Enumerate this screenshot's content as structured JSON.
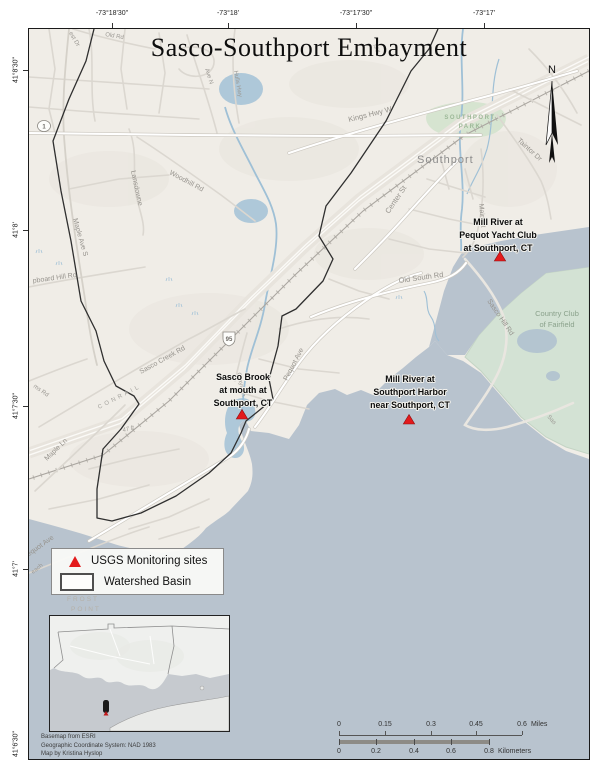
{
  "title": "Sasco-Southport Embayment",
  "north_label": "N",
  "axis": {
    "top": [
      "-73°18'30\"",
      "-73°18'",
      "-73°17'30\"",
      "-73°17'"
    ],
    "left": [
      "41°8'30\"",
      "41°8'",
      "41°7'30\"",
      "41°7'",
      "41°6'30\""
    ]
  },
  "sites": [
    {
      "lines": [
        "Mill River at",
        "Pequot Yacht Club",
        "at Southport, CT"
      ]
    },
    {
      "lines": [
        "Sasco Brook",
        "at mouth at",
        "Southport, CT"
      ]
    },
    {
      "lines": [
        "Mill River at",
        "Southport Harbor",
        "near Southport, CT"
      ]
    }
  ],
  "legend": {
    "monitoring_label": "USGS Monitoring sites",
    "watershed_label": "Watershed Basin"
  },
  "shields": {
    "interstate": "95",
    "us1": "1"
  },
  "map_labels": {
    "old_rd": "Old Rd",
    "est_dr": "est Dr",
    "ave_n": "Ave N",
    "hulls_hwy": "Hulls Hwy",
    "mill": "Mill",
    "kings_hwy_w": "Kings Hwy W",
    "woodhill_rd": "Woodhill Rd",
    "lansdowne": "Lansdowne",
    "maple_ave_s": "Maple Ave S",
    "taintor_dr": "Taintor Dr",
    "southport": "Southport",
    "southport_park_1": "SOUTHPORT",
    "southport_park_2": "PARK",
    "center_st": "Center St",
    "main_st": "Main St",
    "old_south_rd": "Old South Rd",
    "sasco_hill_rd": "Sasco Hill Rd",
    "country_club_1": "Country Club",
    "country_club_2": "of Fairfield",
    "pequot_ave_upper": "Pequot Ave",
    "pequot_ave_lower": "Pequot Ave",
    "sasco_creek_rd": "Sasco Creek Rd",
    "conrail": "CONRAIL",
    "maple_ln": "Maple Ln",
    "ms_rd": "ms Rd",
    "clapboard": "pboard Hill Rd",
    "grays_ln": "Grays Ln",
    "elev_47": "47 ft",
    "beach": "each",
    "frost": "FROST",
    "point": "POINT",
    "sas": "Sas"
  },
  "scalebar": {
    "miles": {
      "ticks": [
        "0",
        "0.15",
        "0.3",
        "0.45",
        "0.6"
      ],
      "unit": "Miles"
    },
    "kilometers": {
      "ticks": [
        "0",
        "0.2",
        "0.4",
        "0.6",
        "0.8"
      ],
      "unit": "Kilometers"
    }
  },
  "credits": [
    "Basemap from ESRI",
    "Geographic Coordinate System: NAD 1983",
    "Map by Kristina Hyslop"
  ],
  "colors": {
    "marker": "#e31a1c",
    "water": "#b8c3ce",
    "stream": "#9fc0d6",
    "green": "#d6e4d0",
    "land": "#f0ede7"
  }
}
